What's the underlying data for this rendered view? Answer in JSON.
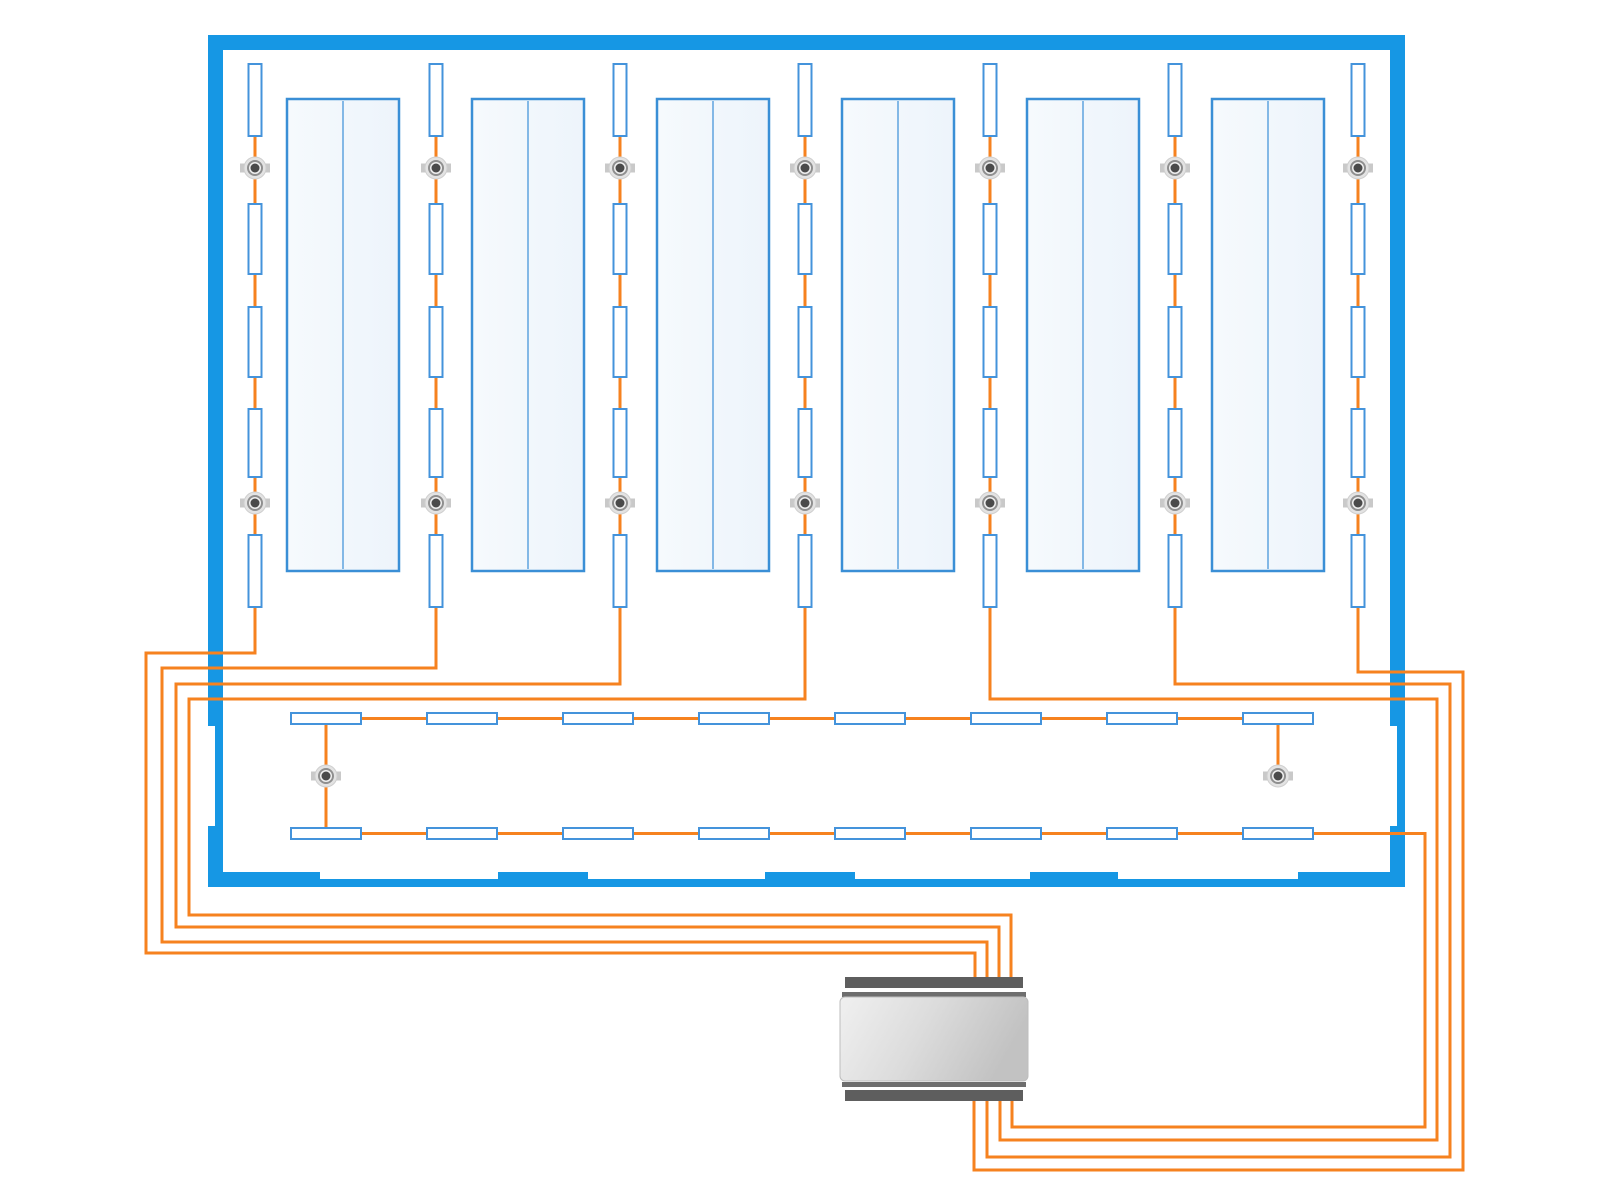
{
  "diagram": {
    "kind": "lighting-control-floorplan",
    "canvas": {
      "width": 1600,
      "height": 1200,
      "background": "#ffffff"
    },
    "colors": {
      "wall_blue": "#1697E4",
      "wire_orange": "#F6821F",
      "rack_fill": "#F4F8FC",
      "rack_border": "#3A8FD6",
      "rack_divider": "#5FA4DF",
      "fixture_border": "#4493DB",
      "fixture_fill": "#FFFFFF",
      "sensor_tab": "#C9C9C9",
      "sensor_outer": "#E3E3E3",
      "sensor_outer_edge": "#CFCFCF",
      "sensor_ring": "#8F8F8F",
      "sensor_ring_fill": "#F0F0F0",
      "sensor_core": "#4A4A4A",
      "device_bar_dark": "#5E5E5E",
      "device_bar_mid": "#6E6E6E",
      "device_body_light": "#EFEFEF",
      "device_body_mid": "#DADADA",
      "device_body_dark": "#C2C2C2",
      "notch_white": "#FFFFFF"
    },
    "building": {
      "x": 208,
      "y": 35,
      "w": 1197,
      "h": 852,
      "wall_thickness": 15,
      "bottom_thin_thickness": 8,
      "dock_tabs_x": [
        [
          208,
          320
        ],
        [
          498,
          588
        ],
        [
          765,
          855
        ],
        [
          1030,
          1118
        ],
        [
          1298,
          1405
        ]
      ],
      "door_openings": [
        {
          "x": 208,
          "y": 726,
          "w": 7,
          "h": 100
        },
        {
          "x": 1390,
          "y": 726,
          "w": 7,
          "h": 100
        }
      ]
    },
    "racks": {
      "count": 6,
      "y": 99,
      "w": 112,
      "h": 472,
      "xs": [
        287,
        472,
        657,
        842,
        1027,
        1212
      ]
    },
    "light_columns": {
      "count": 7,
      "fixture_width": 13,
      "fixture_spans_y": [
        [
          64,
          72
        ],
        [
          204,
          70
        ],
        [
          307,
          70
        ],
        [
          409,
          68
        ],
        [
          535,
          72
        ]
      ],
      "sensor_ys": [
        168,
        503
      ],
      "wire_start_y": 70,
      "columns": [
        {
          "x": 255,
          "side": "left",
          "turn_y": 653,
          "outer_x": 146,
          "run_y": 953,
          "device_x": 975,
          "device_entry_y": 985
        },
        {
          "x": 436,
          "side": "left",
          "turn_y": 668,
          "outer_x": 162,
          "run_y": 942,
          "device_x": 987,
          "device_entry_y": 985
        },
        {
          "x": 620,
          "side": "left",
          "turn_y": 684,
          "outer_x": 176,
          "run_y": 927,
          "device_x": 999,
          "device_entry_y": 985
        },
        {
          "x": 805,
          "side": "left",
          "turn_y": 699,
          "outer_x": 189,
          "run_y": 915,
          "device_x": 1011,
          "device_entry_y": 985
        },
        {
          "x": 990,
          "side": "right",
          "turn_y": 699,
          "outer_x": 1437,
          "run_y": 1140,
          "device_x": 1000,
          "device_entry_y": 1095
        },
        {
          "x": 1175,
          "side": "right",
          "turn_y": 684,
          "outer_x": 1450,
          "run_y": 1157,
          "device_x": 987,
          "device_entry_y": 1095
        },
        {
          "x": 1358,
          "side": "right",
          "turn_y": 672,
          "outer_x": 1463,
          "run_y": 1170,
          "device_x": 974,
          "device_entry_y": 1095
        }
      ]
    },
    "corridor": {
      "rows": [
        {
          "y": 713
        },
        {
          "y": 828
        }
      ],
      "fixture_w": 70,
      "fixture_h": 11,
      "first_x": 291,
      "pitch": 136,
      "count_per_row": 8,
      "sensors": [
        {
          "x": 326,
          "y": 776
        },
        {
          "x": 1278,
          "y": 776
        }
      ],
      "left_drop": {
        "x": 326,
        "y1": 722,
        "y2": 830
      },
      "right_drop": {
        "x": 1278,
        "y1": 722,
        "y2": 776
      },
      "exit_wire": {
        "from_x": 1313,
        "y": 833.5,
        "outer_x": 1425,
        "run_y": 1127,
        "device_x": 1012,
        "device_entry_y": 1095
      }
    },
    "device": {
      "body": {
        "x": 840,
        "y": 997,
        "w": 188,
        "h": 84,
        "radius": 5
      },
      "bars": [
        {
          "x": 845,
          "y": 977,
          "w": 178,
          "h": 11,
          "tone": "dark"
        },
        {
          "x": 842,
          "y": 992,
          "w": 184,
          "h": 5,
          "tone": "mid"
        },
        {
          "x": 842,
          "y": 1082,
          "w": 184,
          "h": 5,
          "tone": "mid"
        },
        {
          "x": 845,
          "y": 1090,
          "w": 178,
          "h": 11,
          "tone": "dark"
        }
      ]
    },
    "wire_width": 3,
    "counts": {
      "racks": 6,
      "hall_fixture_columns": 7,
      "fixtures_per_column": 5,
      "sensors_per_column": 2,
      "corridor_rows": 2,
      "corridor_fixtures_per_row": 8,
      "corridor_sensors": 2,
      "total_fixtures": 51,
      "total_sensors": 16,
      "controller_devices": 1
    }
  }
}
